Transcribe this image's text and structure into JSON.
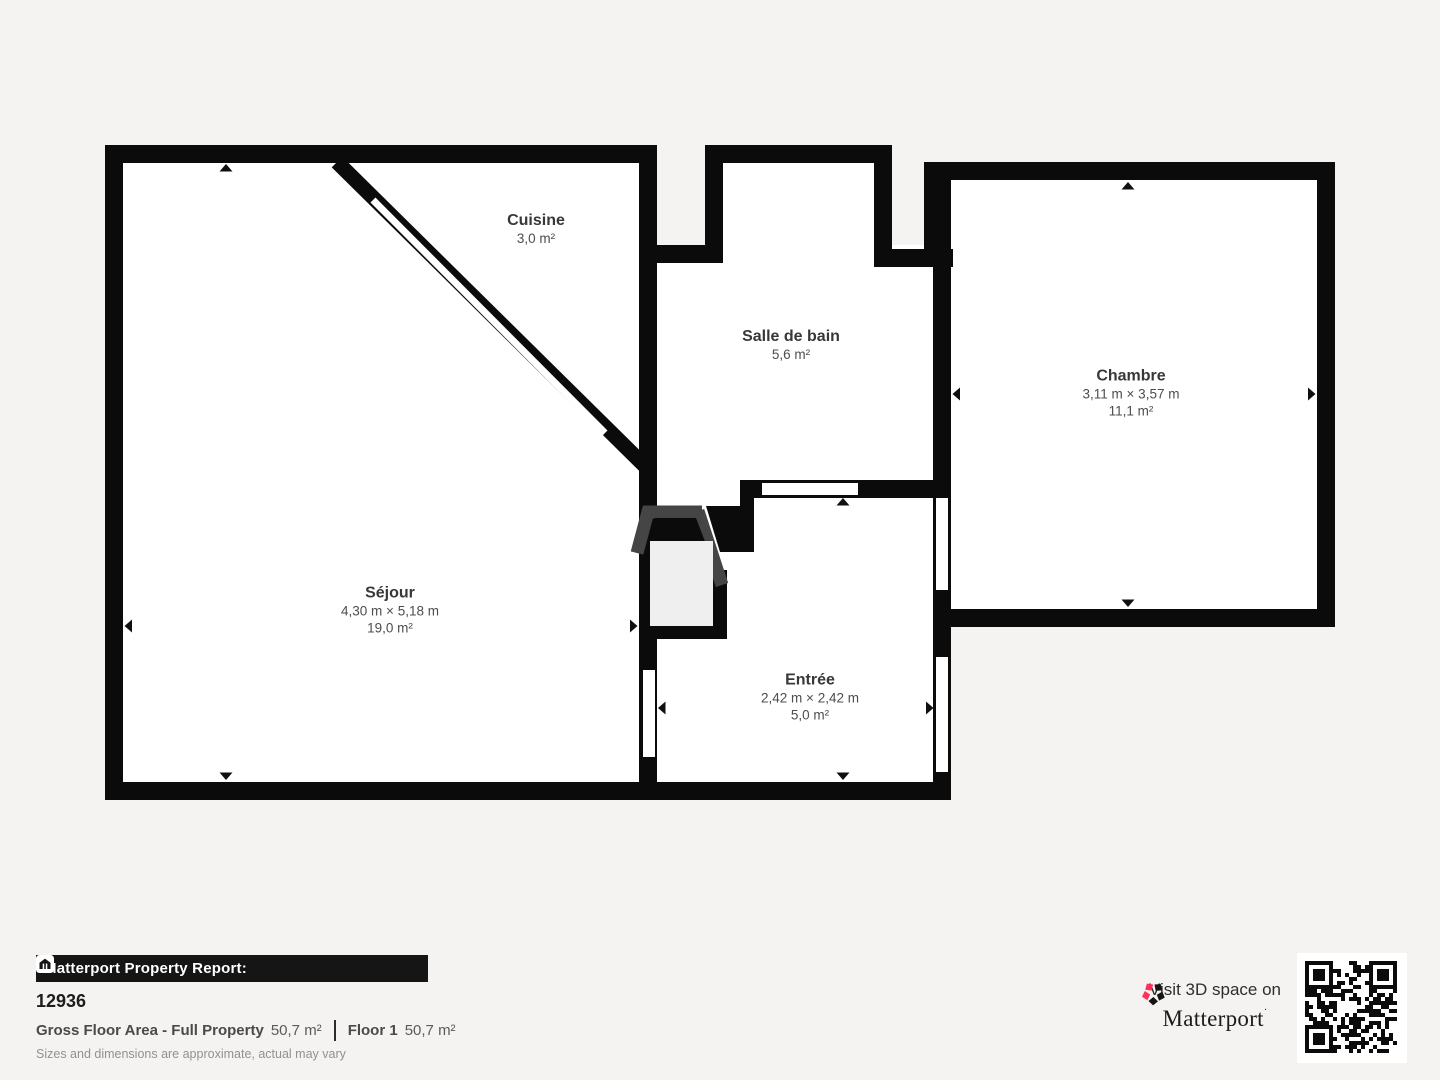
{
  "colors": {
    "background": "#f4f3f1",
    "wall": "#0b0b0b",
    "interior": "#ffffff",
    "closet_gray": "#454545",
    "closet_light": "#efefef",
    "brand_pink": "#ff3158"
  },
  "rooms": {
    "cuisine": {
      "name": "Cuisine",
      "area": "3,0 m²"
    },
    "salle_de_bain": {
      "name": "Salle de bain",
      "area": "5,6 m²"
    },
    "sejour": {
      "name": "Séjour",
      "dims": "4,30 m × 5,18 m",
      "area": "19,0 m²"
    },
    "entree": {
      "name": "Entrée",
      "dims": "2,42 m × 2,42 m",
      "area": "5,0 m²"
    },
    "chambre": {
      "name": "Chambre",
      "dims": "3,11 m × 3,57 m",
      "area": "11,1 m²"
    }
  },
  "footer": {
    "report_label": "Matterport Property Report:",
    "property_id": "12936",
    "gfa_label": "Gross Floor Area - Full Property",
    "gfa_value": "50,7 m²",
    "floor_label": "Floor 1",
    "floor_value": "50,7 m²",
    "disclaimer": "Sizes and dimensions are approximate, actual may vary"
  },
  "promo": {
    "visit_text": "Visit 3D space on",
    "brand": "Matterport",
    "brand_mark": "·"
  }
}
